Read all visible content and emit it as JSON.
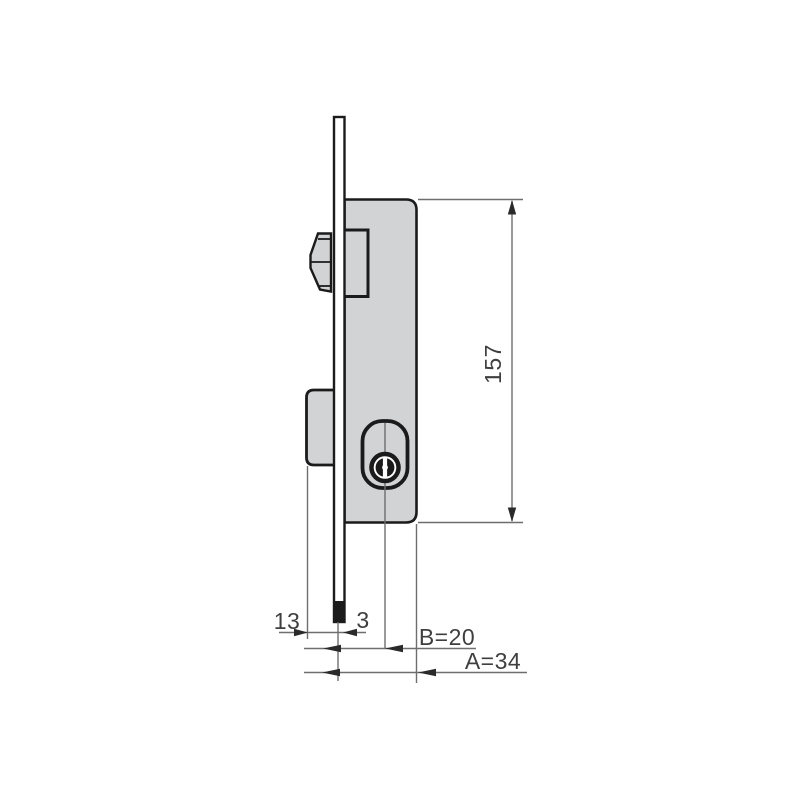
{
  "diagram": {
    "type": "technical-drawing",
    "subject": "mortise lock side profile with oval cylinder and faceplate",
    "background": "#ffffff",
    "colors": {
      "outline": "#1b1b1b",
      "part_fill": "#d2d3d5",
      "dimension_lines": "#6e6e6e",
      "label_text": "#3f3f3f"
    },
    "dimensions": {
      "case_height": "157",
      "bolt_projection": "13",
      "faceplate_thickness": "3",
      "backset": "B=20",
      "case_depth": "A=34"
    },
    "parts": [
      "faceplate",
      "lock-case",
      "latch-bolt",
      "deadbolt",
      "cylinder-keyway"
    ]
  }
}
